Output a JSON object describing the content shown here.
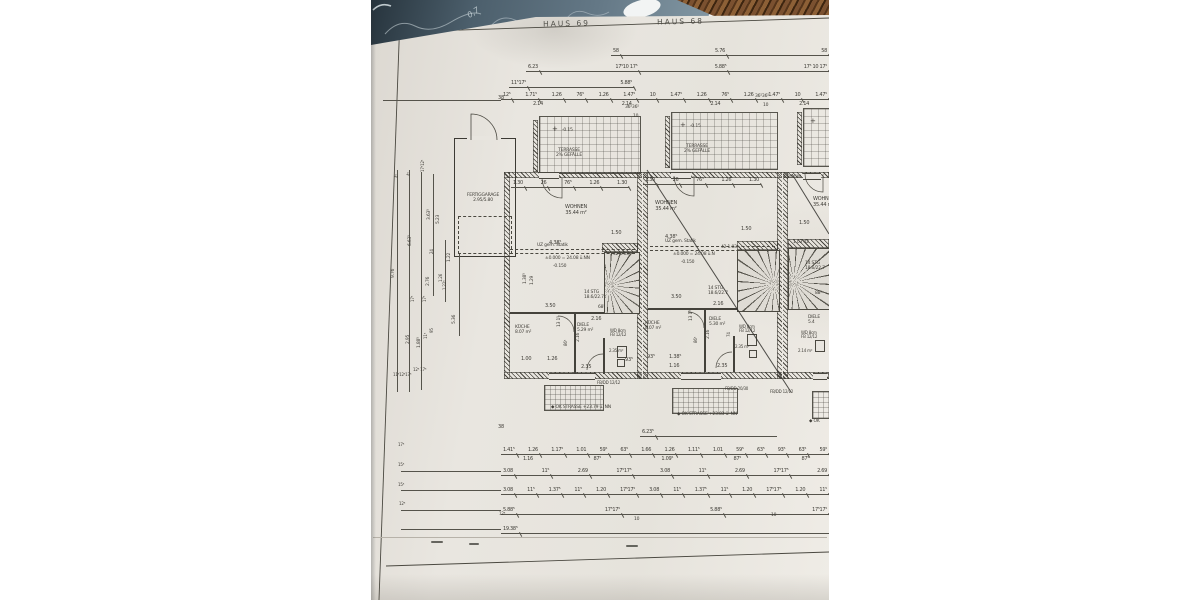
{
  "photo": {
    "desk_note": "0,7",
    "paper_color": "#e8e5df",
    "desk_color": "#5d7181",
    "ink_color": "#403e38",
    "pencil_color": "#7b5130"
  },
  "plan": {
    "title_left": "HAUS 69",
    "title_right": "HAUS 68",
    "dim_rows": [
      {
        "x": 240,
        "y": 48,
        "w": 218,
        "l": [
          "58",
          "5.76",
          "58"
        ]
      },
      {
        "x": 155,
        "y": 64,
        "w": 303,
        "l": [
          "6.23",
          "17⁵10 17⁵",
          "5.88⁵",
          "17⁵ 10 17⁵"
        ]
      },
      {
        "x": 138,
        "y": 80,
        "w": 125,
        "l": [
          "11⁵17⁵",
          "5.88⁵"
        ]
      },
      {
        "x": 130,
        "y": 92,
        "w": 328,
        "l": [
          "12⁵",
          "1.71⁵",
          "1.26",
          "76⁵",
          "1.26",
          "1.47⁵",
          "10",
          "1.47⁵",
          "1.26",
          "76⁵",
          "1.26",
          "1.47⁵",
          "10",
          "1.47⁵"
        ]
      },
      {
        "x": 160,
        "y": 101,
        "w": 280,
        "noline": 1,
        "l": [
          "2.14",
          "2.14",
          "2.14",
          "2.14"
        ]
      },
      {
        "x": 140,
        "y": 180,
        "w": 118,
        "l": [
          "1.30",
          "26",
          "76⁵",
          "1.26",
          "1.30"
        ]
      },
      {
        "x": 272,
        "y": 177,
        "w": 118,
        "l": [
          "1.30",
          "26",
          "76⁵",
          "1.26",
          "1.30"
        ]
      },
      {
        "x": 269,
        "y": 429,
        "w": 137,
        "l": [
          "6.23⁵"
        ]
      },
      {
        "x": 130,
        "y": 447,
        "w": 328,
        "l": [
          "1.41⁵",
          "1.26",
          "1.17⁵",
          "1.01",
          "59⁵",
          "63⁵",
          "1.66",
          "1.26",
          "1.11⁵",
          "1.01",
          "59⁵",
          "63⁵",
          "93⁵",
          "63⁵",
          "59⁵"
        ]
      },
      {
        "x": 150,
        "y": 456,
        "w": 290,
        "noline": 1,
        "l": [
          "1.16",
          "87⁵",
          "1.09⁵",
          "87⁵",
          "87⁵"
        ]
      },
      {
        "x": 130,
        "y": 468,
        "w": 328,
        "l": [
          "3.08",
          "11⁵",
          "2.69",
          "17⁵17⁵",
          "3.08",
          "11⁵",
          "2.69",
          "17⁵17⁵",
          "2.69"
        ]
      },
      {
        "x": 130,
        "y": 487,
        "w": 328,
        "l": [
          "3.08",
          "11⁵",
          "1.37⁵",
          "11⁵",
          "1.20",
          "17⁵17⁵",
          "3.08",
          "11⁵",
          "1.37⁵",
          "11⁵",
          "1.20",
          "17⁵17⁵",
          "1.20",
          "11⁵"
        ]
      },
      {
        "x": 130,
        "y": 507,
        "w": 328,
        "l": [
          "5.88⁵",
          "17⁵17⁵",
          "5.88⁵",
          "17⁵17⁵"
        ]
      },
      {
        "x": 130,
        "y": 526,
        "w": 328,
        "l": [
          "19.38⁵"
        ]
      }
    ],
    "vlines": [
      {
        "x": 26,
        "y": 170,
        "h": 222
      },
      {
        "x": 38,
        "y": 170,
        "h": 222
      },
      {
        "x": 50,
        "y": 172,
        "h": 218
      },
      {
        "x": 62,
        "y": 174,
        "h": 122
      },
      {
        "x": 74,
        "y": 240,
        "h": 62
      },
      {
        "x": 88,
        "y": 254,
        "h": 82
      }
    ],
    "hlines": [
      {
        "x": 12,
        "y": 100,
        "w": 118
      },
      {
        "x": 30,
        "y": 471,
        "w": 100
      },
      {
        "x": 30,
        "y": 490,
        "w": 100
      },
      {
        "x": 30,
        "y": 510,
        "w": 100
      },
      {
        "x": 30,
        "y": 529,
        "w": 100
      }
    ],
    "notes": [
      {
        "t": "38",
        "x": 127,
        "y": 96,
        "fs": 5
      },
      {
        "t": "36⁵36⁵",
        "x": 254,
        "y": 105,
        "fs": 4.5
      },
      {
        "t": "10",
        "x": 262,
        "y": 114,
        "fs": 4.5
      },
      {
        "t": "36⁵36⁵",
        "x": 384,
        "y": 94,
        "fs": 4.5
      },
      {
        "t": "10",
        "x": 392,
        "y": 103,
        "fs": 4.5
      },
      {
        "t": "+",
        "x": 181,
        "y": 126,
        "fs": 7
      },
      {
        "t": "-0.15",
        "x": 191,
        "y": 128,
        "fs": 4.5
      },
      {
        "t": "TERRASSE\n2% GEFÄLLE",
        "x": 176,
        "y": 148,
        "fs": 4.5,
        "c": 1,
        "w": 44
      },
      {
        "t": "+",
        "x": 309,
        "y": 122,
        "fs": 7
      },
      {
        "t": "-0.15",
        "x": 319,
        "y": 124,
        "fs": 4.5
      },
      {
        "t": "TERRASSE\n2% GEFÄLLE",
        "x": 304,
        "y": 144,
        "fs": 4.5,
        "c": 1,
        "w": 44
      },
      {
        "t": "+",
        "x": 439,
        "y": 118,
        "fs": 7
      },
      {
        "t": "1.30 GW",
        "x": 412,
        "y": 175,
        "fs": 4.5
      },
      {
        "t": "WOHNEN\n35.44 m²",
        "x": 184,
        "y": 205,
        "fs": 5,
        "c": 1,
        "w": 42
      },
      {
        "t": "WOHNEN\n35.44 m²",
        "x": 274,
        "y": 201,
        "fs": 5,
        "c": 1,
        "w": 42
      },
      {
        "t": "WOHNEN\n35.44 m²",
        "x": 442,
        "y": 197,
        "fs": 5
      },
      {
        "t": "4.38⁵",
        "x": 178,
        "y": 241,
        "fs": 5
      },
      {
        "t": "1.50",
        "x": 240,
        "y": 231,
        "fs": 5
      },
      {
        "t": "42  1.03",
        "x": 242,
        "y": 252,
        "fs": 4.5
      },
      {
        "t": "4.38⁵",
        "x": 294,
        "y": 235,
        "fs": 5
      },
      {
        "t": "1.50",
        "x": 370,
        "y": 227,
        "fs": 5
      },
      {
        "t": "42  1.03",
        "x": 350,
        "y": 245,
        "fs": 4.5
      },
      {
        "t": "1.50",
        "x": 428,
        "y": 221,
        "fs": 5
      },
      {
        "t": "1.03  42",
        "x": 422,
        "y": 240,
        "fs": 4.5
      },
      {
        "t": "UZ gem. Statik",
        "x": 166,
        "y": 243,
        "fs": 4.5
      },
      {
        "t": "±0.000 = 24.08 ü.NN",
        "x": 174,
        "y": 256,
        "fs": 4.5
      },
      {
        "t": "-0.150",
        "x": 182,
        "y": 264,
        "fs": 4.5
      },
      {
        "t": "UZ gem. Statik",
        "x": 294,
        "y": 239,
        "fs": 4.5
      },
      {
        "t": "±0.000 = 24.08 ü.N",
        "x": 302,
        "y": 252,
        "fs": 4.5
      },
      {
        "t": "-0.150",
        "x": 310,
        "y": 260,
        "fs": 4.5
      },
      {
        "t": "14 STG\n18.6/22.7",
        "x": 213,
        "y": 290,
        "fs": 4.5
      },
      {
        "t": "14 STG\n18.6/22.7",
        "x": 337,
        "y": 286,
        "fs": 4.5
      },
      {
        "t": "14 STG\n18.6/22.7",
        "x": 434,
        "y": 261,
        "fs": 4.5
      },
      {
        "t": "88⁵",
        "x": 444,
        "y": 291,
        "fs": 4.5
      },
      {
        "t": "3.50",
        "x": 174,
        "y": 304,
        "fs": 5
      },
      {
        "t": "68⁵",
        "x": 227,
        "y": 305,
        "fs": 4.5
      },
      {
        "t": "2.16",
        "x": 220,
        "y": 317,
        "fs": 5
      },
      {
        "t": "3.50",
        "x": 300,
        "y": 295,
        "fs": 5
      },
      {
        "t": "2.16",
        "x": 342,
        "y": 302,
        "fs": 5
      },
      {
        "t": "KÜCHE\n8.07 m²",
        "x": 144,
        "y": 325,
        "fs": 4.5
      },
      {
        "t": "DIELE\n5.29 m²",
        "x": 206,
        "y": 323,
        "fs": 4.5
      },
      {
        "t": "WD 8cm\nFB 12/12",
        "x": 239,
        "y": 329,
        "fs": 4
      },
      {
        "t": "2.35 m²",
        "x": 238,
        "y": 349,
        "fs": 4
      },
      {
        "t": "KÜCHE\n8.07 m²",
        "x": 274,
        "y": 321,
        "fs": 4.5
      },
      {
        "t": "DIELE\n5.30 m²",
        "x": 338,
        "y": 317,
        "fs": 4.5
      },
      {
        "t": "WD 8cm\nFB 12/12",
        "x": 368,
        "y": 325,
        "fs": 4
      },
      {
        "t": "2.35 m²",
        "x": 364,
        "y": 345,
        "fs": 4
      },
      {
        "t": "DIELE\n5.4",
        "x": 437,
        "y": 315,
        "fs": 4.5
      },
      {
        "t": "WD 8cm\nFB 12/12",
        "x": 430,
        "y": 331,
        "fs": 4
      },
      {
        "t": "2.14 m²",
        "x": 427,
        "y": 349,
        "fs": 4
      },
      {
        "t": "13 1⁵",
        "x": 186,
        "y": 327,
        "fs": 4.5,
        "r": 1
      },
      {
        "t": "86⁵",
        "x": 193,
        "y": 346,
        "fs": 4,
        "r": 1
      },
      {
        "t": "2.16",
        "x": 205,
        "y": 342,
        "fs": 4.5,
        "r": 1
      },
      {
        "t": "1.38⁵",
        "x": 152,
        "y": 284,
        "fs": 4.5,
        "r": 1
      },
      {
        "t": "1.29",
        "x": 159,
        "y": 285,
        "fs": 4.5,
        "r": 1
      },
      {
        "t": "13 1⁵",
        "x": 318,
        "y": 321,
        "fs": 4.5,
        "r": 1
      },
      {
        "t": "86⁵",
        "x": 323,
        "y": 343,
        "fs": 4,
        "r": 1
      },
      {
        "t": "2.16",
        "x": 335,
        "y": 339,
        "fs": 4.5,
        "r": 1
      },
      {
        "t": "74",
        "x": 356,
        "y": 337,
        "fs": 4,
        "r": 1
      },
      {
        "t": "1.00",
        "x": 150,
        "y": 357,
        "fs": 5
      },
      {
        "t": "1.26",
        "x": 176,
        "y": 357,
        "fs": 5
      },
      {
        "t": "2.35",
        "x": 210,
        "y": 365,
        "fs": 5
      },
      {
        "t": "93⁵",
        "x": 254,
        "y": 358,
        "fs": 5
      },
      {
        "t": "93⁵",
        "x": 276,
        "y": 355,
        "fs": 5
      },
      {
        "t": "1.38⁵",
        "x": 298,
        "y": 355,
        "fs": 5
      },
      {
        "t": "1.16",
        "x": 298,
        "y": 364,
        "fs": 5
      },
      {
        "t": "2.35",
        "x": 346,
        "y": 364,
        "fs": 5
      },
      {
        "t": "FERTIGGARAGE\n2.95/5.80",
        "x": 86,
        "y": 193,
        "fs": 4.5,
        "c": 1,
        "w": 52
      },
      {
        "t": "9.76",
        "x": 20,
        "y": 278,
        "fs": 4.5,
        "r": 1
      },
      {
        "t": "6.63⁵",
        "x": 37,
        "y": 246,
        "fs": 4.5,
        "r": 1
      },
      {
        "t": "3.63⁵",
        "x": 56,
        "y": 220,
        "fs": 4.5,
        "r": 1
      },
      {
        "t": "5.23",
        "x": 65,
        "y": 224,
        "fs": 4.5,
        "r": 1
      },
      {
        "t": "24",
        "x": 59,
        "y": 254,
        "fs": 4,
        "r": 1
      },
      {
        "t": "1.22",
        "x": 76,
        "y": 262,
        "fs": 4.5,
        "r": 1
      },
      {
        "t": "2.76",
        "x": 55,
        "y": 286,
        "fs": 4.5,
        "r": 1
      },
      {
        "t": "1.26",
        "x": 68,
        "y": 282,
        "fs": 4,
        "r": 1
      },
      {
        "t": "1.22⁵",
        "x": 72,
        "y": 290,
        "fs": 4,
        "r": 1
      },
      {
        "t": "5.36",
        "x": 81,
        "y": 324,
        "fs": 4.5,
        "r": 1
      },
      {
        "t": "2.95",
        "x": 35,
        "y": 344,
        "fs": 4.5,
        "r": 1
      },
      {
        "t": "1.88⁵",
        "x": 46,
        "y": 348,
        "fs": 4.5,
        "r": 1
      },
      {
        "t": "11⁵",
        "x": 53,
        "y": 339,
        "fs": 4,
        "r": 1
      },
      {
        "t": "95",
        "x": 59,
        "y": 333,
        "fs": 4,
        "r": 1
      },
      {
        "t": "17⁵",
        "x": 40,
        "y": 302,
        "fs": 4,
        "r": 1
      },
      {
        "t": "17⁵",
        "x": 52,
        "y": 302,
        "fs": 4,
        "r": 1
      },
      {
        "t": "4⁵",
        "x": 24,
        "y": 178,
        "fs": 4,
        "r": 1
      },
      {
        "t": "4⁵",
        "x": 36,
        "y": 176,
        "fs": 4,
        "r": 1
      },
      {
        "t": "17⁵12⁵",
        "x": 50,
        "y": 172,
        "fs": 4,
        "r": 1
      },
      {
        "t": "12⁵ 17⁵",
        "x": 42,
        "y": 368,
        "fs": 4
      },
      {
        "t": "11⁵12⁵17⁵",
        "x": 22,
        "y": 373,
        "fs": 4
      },
      {
        "t": "38",
        "x": 127,
        "y": 425,
        "fs": 5
      },
      {
        "t": "◆ OK STRASSE +23.79 ü. NN",
        "x": 180,
        "y": 405,
        "fs": 4.5
      },
      {
        "t": "◆ OK STRASSE +23.83 ü. NN",
        "x": 306,
        "y": 412,
        "fs": 4.5
      },
      {
        "t": "◆ OK",
        "x": 438,
        "y": 419,
        "fs": 4.5
      },
      {
        "t": "FB/DD 12/12",
        "x": 226,
        "y": 381,
        "fs": 4
      },
      {
        "t": "FB/DD 20/30",
        "x": 354,
        "y": 387,
        "fs": 4
      },
      {
        "t": "FB/DD 12/12",
        "x": 399,
        "y": 390,
        "fs": 4
      },
      {
        "t": "17⁵",
        "x": 27,
        "y": 443,
        "fs": 4
      },
      {
        "t": "15⁵",
        "x": 27,
        "y": 463,
        "fs": 4
      },
      {
        "t": "15⁵",
        "x": 27,
        "y": 483,
        "fs": 4
      },
      {
        "t": "12⁵",
        "x": 28,
        "y": 502,
        "fs": 4
      },
      {
        "t": "12⁵",
        "x": 128,
        "y": 512,
        "fs": 4
      },
      {
        "t": "10",
        "x": 263,
        "y": 517,
        "fs": 4.5
      },
      {
        "t": "10",
        "x": 400,
        "y": 513,
        "fs": 4.5
      }
    ]
  }
}
